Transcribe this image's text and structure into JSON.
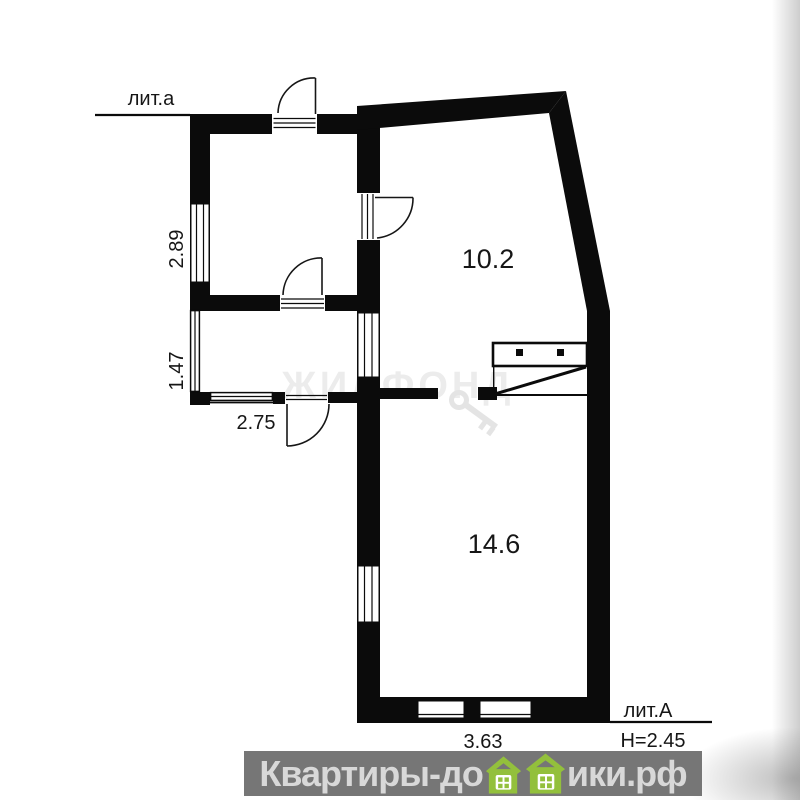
{
  "colors": {
    "wall": "#0b0b0b",
    "text": "#161616",
    "watermark": "#ececec",
    "banner_bg": "#767676",
    "banner_text": "#d8d8d8",
    "house_green": "#93c03c"
  },
  "plan": {
    "building_label_top": "лит.а",
    "building_label_main": "лит.А",
    "ceiling_height": "H=2.45",
    "dims": {
      "room_top_left_height": "2.89",
      "room_small_height": "1.47",
      "room_small_width": "2.75",
      "bottom_width": "3.63"
    },
    "areas": {
      "room_upper": "10.2",
      "room_lower": "14.6"
    }
  },
  "watermarks": {
    "agency": "ЖИЛФОНД",
    "site_prefix": "Квартиры-до",
    "site_suffix": "ики.рф"
  }
}
